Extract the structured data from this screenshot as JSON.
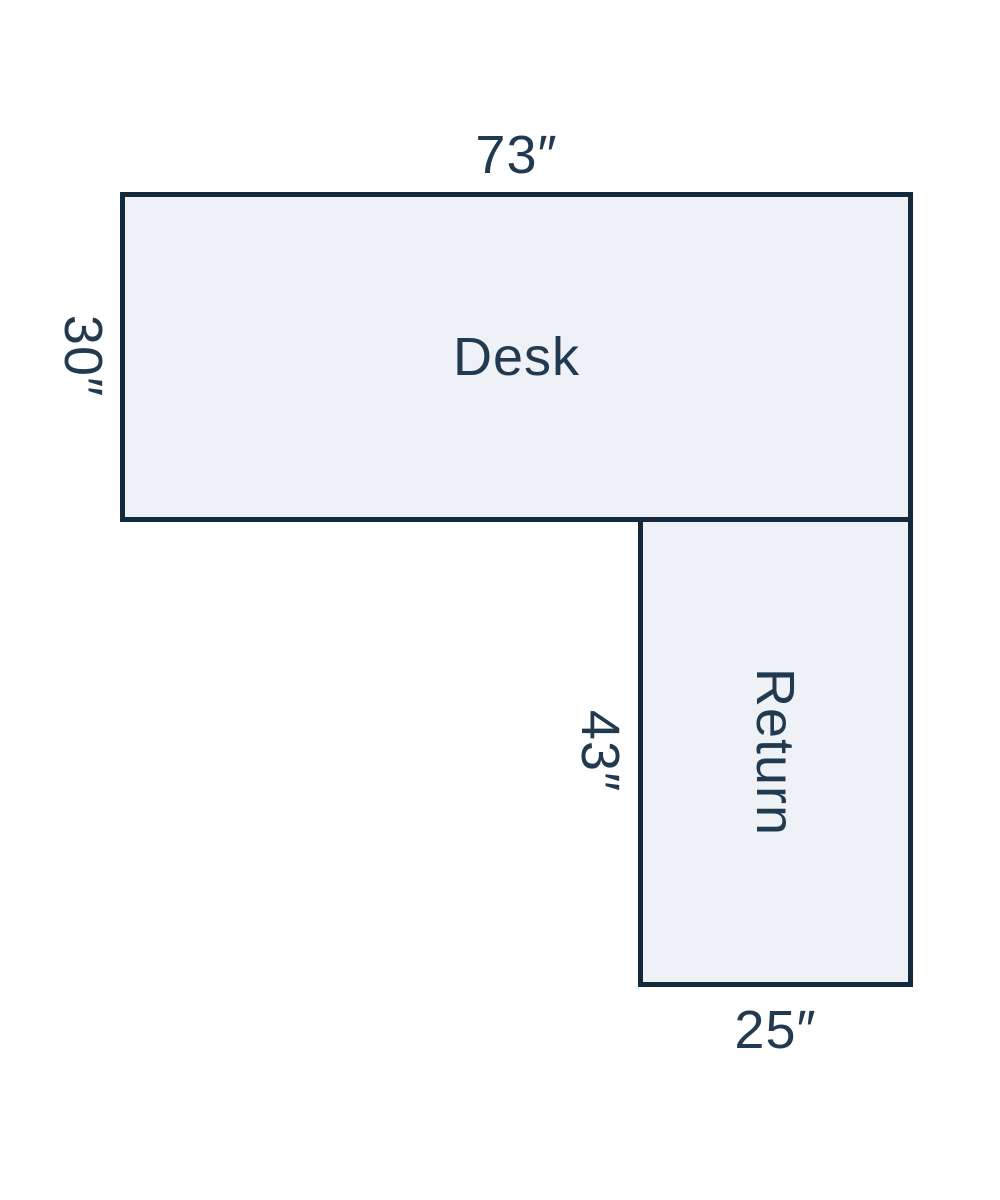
{
  "diagram": {
    "desk": {
      "label": "Desk",
      "width_label": "73″",
      "depth_label": "30″"
    },
    "return": {
      "label": "Return",
      "length_label": "43″",
      "width_label": "25″"
    },
    "colors": {
      "background": "#ffffff",
      "shape_fill": "#eef1f6",
      "shape_border": "#14293c",
      "text": "#223a50"
    }
  }
}
